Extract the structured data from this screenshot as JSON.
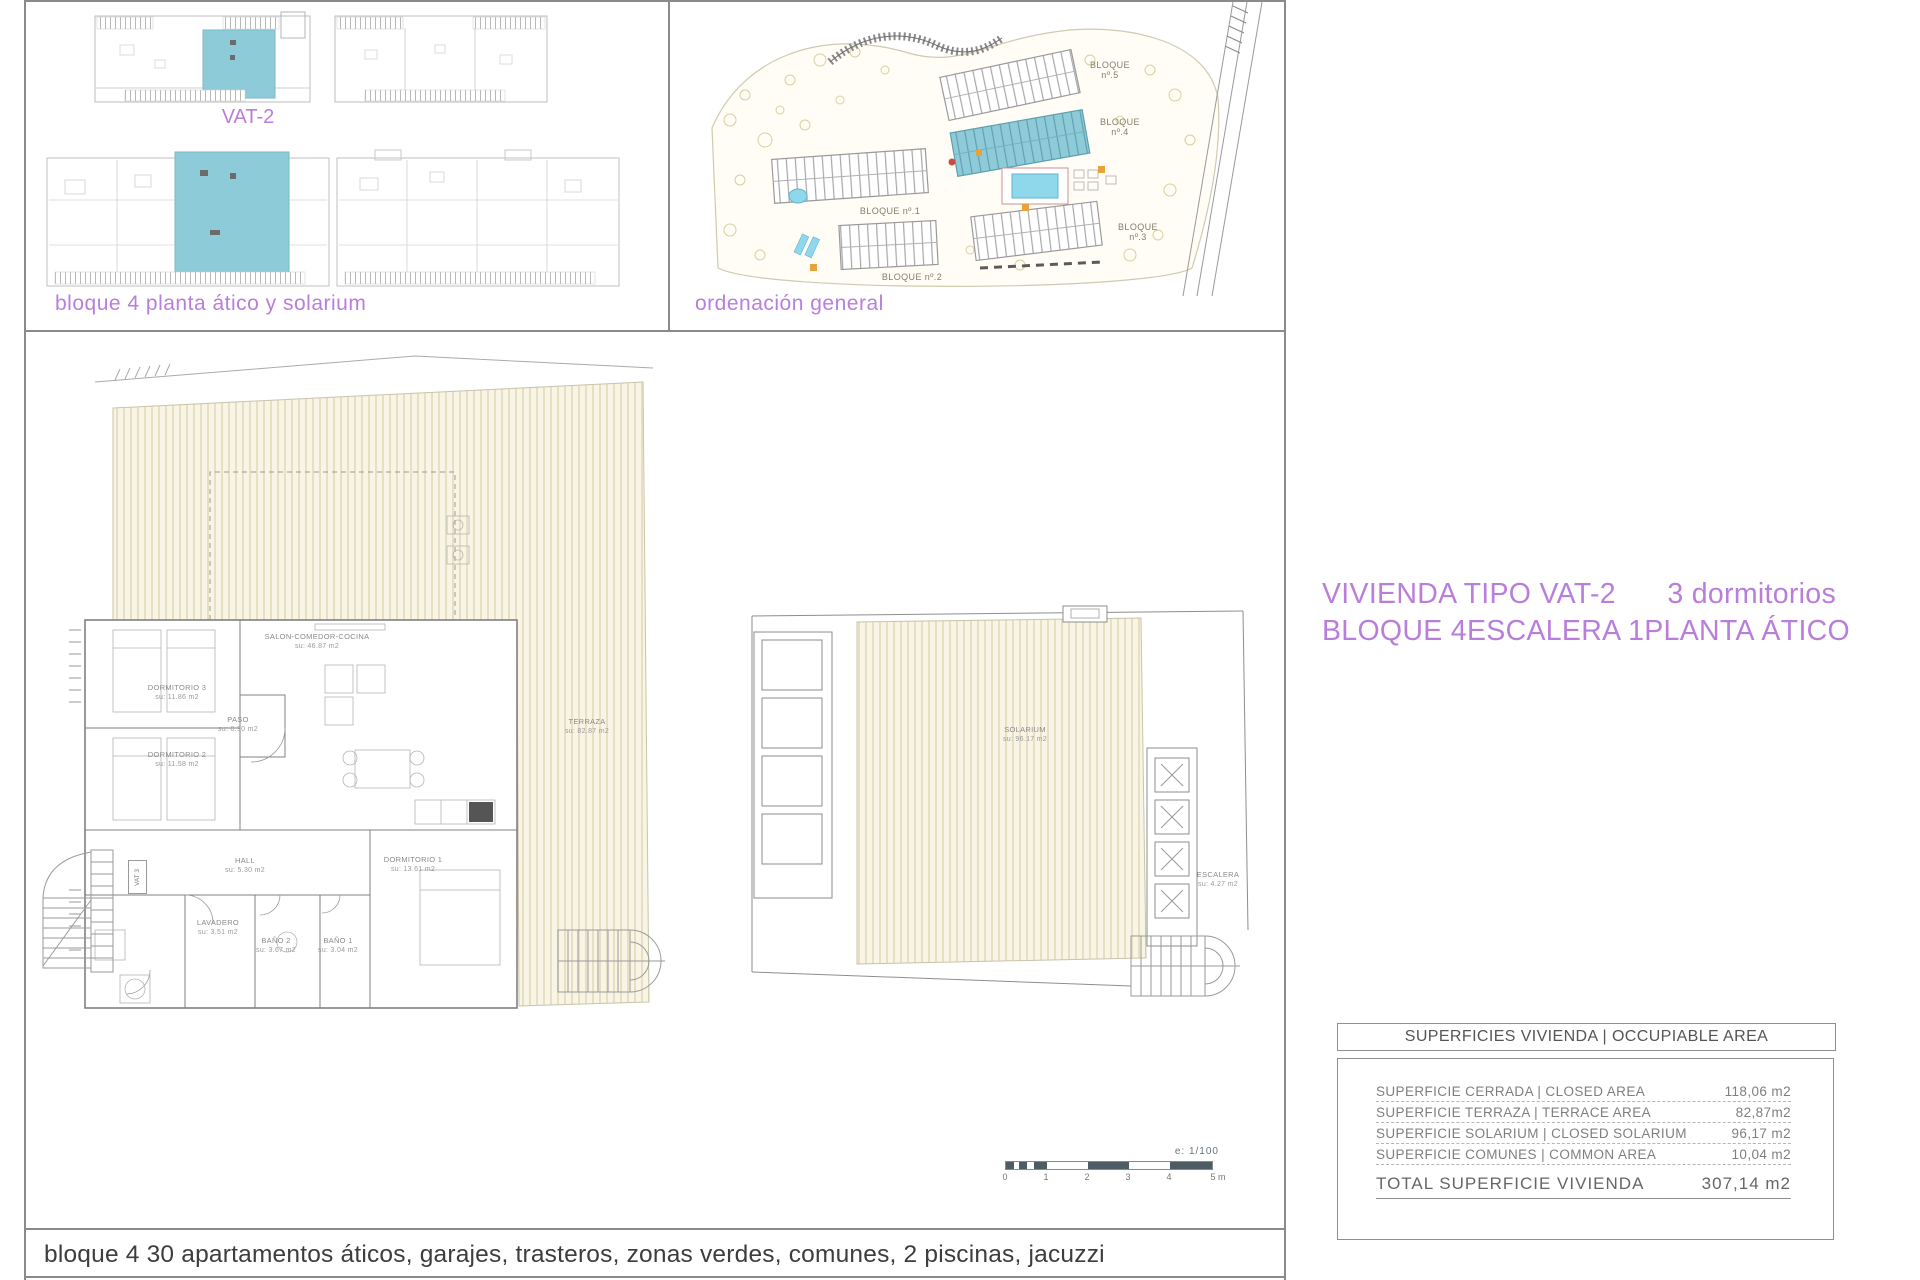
{
  "colors": {
    "accent_purple": "#b97edb",
    "highlight_teal": "#8ecbd8",
    "pool_cyan": "#8fd8ec",
    "orange_accent": "#e8a23c",
    "hatch_cream": "#e6dfc2"
  },
  "panel_top_left": {
    "vat_label": "VAT-2",
    "caption": "bloque 4 planta ático y solarium"
  },
  "site_panel": {
    "caption": "ordenación general",
    "blocks": [
      {
        "name": "BLOQUE",
        "num": "nº.5"
      },
      {
        "name": "BLOQUE",
        "num": "nº.4"
      },
      {
        "name": "BLOQUE nº.1",
        "num": ""
      },
      {
        "name": "BLOQUE nº.2",
        "num": ""
      },
      {
        "name": "BLOQUE",
        "num": "nº.3"
      }
    ]
  },
  "floor_plan": {
    "vat3_tag": "VAT 3",
    "rooms": [
      {
        "name": "DORMITORIO 3",
        "area": "su: 11.86 m2"
      },
      {
        "name": "PASO",
        "area": "su: 0.90 m2"
      },
      {
        "name": "DORMITORIO 2",
        "area": "su: 11.58 m2"
      },
      {
        "name": "SALON-COMEDOR-COCINA",
        "area": "su: 46.87 m2"
      },
      {
        "name": "HALL",
        "area": "su: 5.30 m2"
      },
      {
        "name": "DORMITORIO 1",
        "area": "su: 13.61 m2"
      },
      {
        "name": "LAVADERO",
        "area": "su: 3.51 m2"
      },
      {
        "name": "BAÑO 2",
        "area": "su: 3.67 m2"
      },
      {
        "name": "BAÑO 1",
        "area": "su: 3.04 m2"
      },
      {
        "name": "TERRAZA",
        "area": "su: 82.87 m2"
      },
      {
        "name": "SOLARIUM",
        "area": "su: 96.17 m2"
      },
      {
        "name": "ESCALERA",
        "area": "su: 4.27 m2"
      }
    ]
  },
  "scale_bar": {
    "label": "e: 1/100",
    "ticks": [
      "0",
      "1",
      "2",
      "3",
      "4",
      "5 m"
    ]
  },
  "title_block": {
    "line1_left": "VIVIENDA TIPO VAT-2",
    "line1_right": "3 dormitorios",
    "line2_a": "BLOQUE 4",
    "line2_b": "ESCALERA 1",
    "line2_c": "PLANTA ÁTICO"
  },
  "area_table": {
    "header": "SUPERFICIES VIVIENDA | OCCUPIABLE AREA",
    "rows": [
      {
        "label": "SUPERFICIE CERRADA | CLOSED AREA",
        "value": "118,06 m2"
      },
      {
        "label": "SUPERFICIE TERRAZA   | TERRACE AREA",
        "value": "82,87m2"
      },
      {
        "label": "SUPERFICIE SOLARIUM | CLOSED SOLARIUM",
        "value": "96,17 m2"
      },
      {
        "label": "SUPERFICIE COMUNES | COMMON AREA",
        "value": "10,04 m2"
      }
    ],
    "total": {
      "label": "TOTAL SUPERFICIE VIVIENDA",
      "value": "307,14 m2"
    }
  },
  "footer_caption": "bloque 4 30 apartamentos áticos, garajes, trasteros, zonas verdes, comunes, 2 piscinas, jacuzzi"
}
